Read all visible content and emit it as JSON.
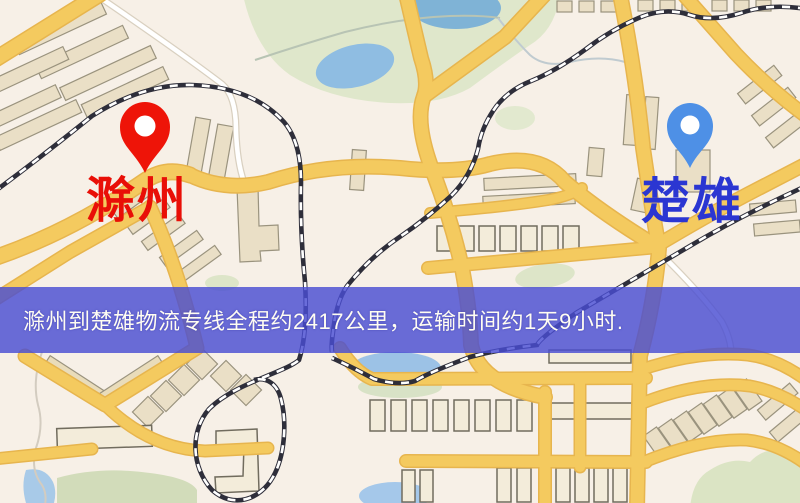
{
  "banner": {
    "text": "滁州到楚雄物流专线全程约2417公里，运输时间约1天9小时.",
    "background_color": "#494dd2",
    "text_color": "#fffdf2"
  },
  "markers": {
    "origin": {
      "label": "滁州",
      "label_color": "#e90f07",
      "pin_color": "#ee1408"
    },
    "destination": {
      "label": "楚雄",
      "label_color": "#2b36d2",
      "pin_color": "#4e90e6"
    }
  },
  "map": {
    "theme_colors": {
      "background": "#f7f0e7",
      "road_yellow": "#f4ca5f",
      "road_casing": "#e7b54e",
      "park_green": "#dfe7cb",
      "water_blue": "#8fbde2",
      "building_tan": "#eadfc6",
      "railway_dark": "#2e2e3a"
    }
  }
}
